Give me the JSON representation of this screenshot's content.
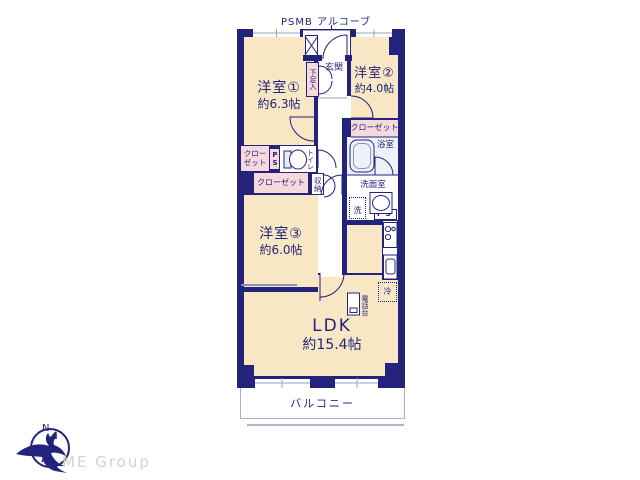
{
  "plan": {
    "top_label": "PSMB アルコーブ",
    "rooms": {
      "room1": {
        "name": "洋室①",
        "size": "約6.3帖"
      },
      "room2": {
        "name": "洋室②",
        "size": "約4.0帖"
      },
      "room3": {
        "name": "洋室③",
        "size": "約6.0帖"
      },
      "ldk": {
        "name": "LDK",
        "size": "約15.4帖"
      },
      "genkan": "玄関",
      "balcony": "バルコニー",
      "bath": "浴室",
      "washroom": "洗面室",
      "toilet": "トイレ",
      "shoe_cabinet": "下足入",
      "storage": "収納",
      "closet": "クローゼット",
      "closet_line1": "クロー",
      "closet_line2": "ゼット",
      "pipe_space": "PS",
      "washer": "洗",
      "fridge": "冷",
      "phone_stand": "電話台"
    },
    "colors": {
      "wall": "#23237b",
      "room_fill": "#f7e7c4",
      "closet_fill": "#f6d9dc",
      "bath_fill": "#edf2f9",
      "thin_line": "#9aa3c0"
    }
  },
  "footer": {
    "logo_text": "ME Group",
    "compass_letter": "N"
  }
}
